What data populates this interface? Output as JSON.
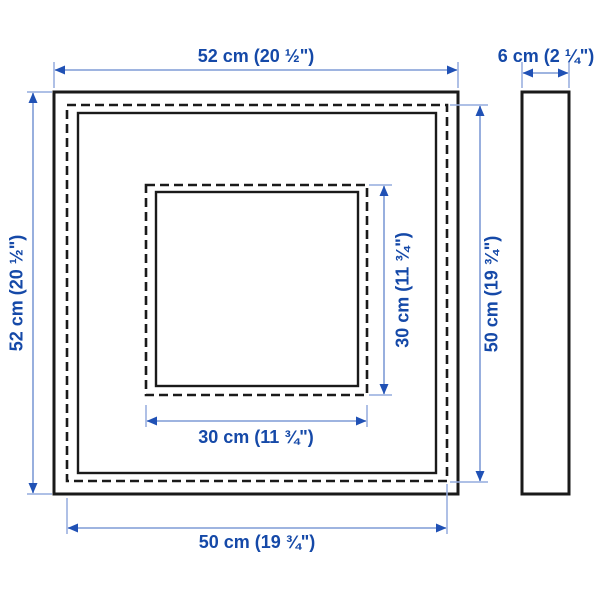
{
  "diagram": {
    "type": "product-measurement-illustration",
    "views": {
      "front": "frame-front-view",
      "side": "frame-side-profile-view"
    }
  },
  "dimensions": {
    "outer_width": "52 cm (20 ½\")",
    "outer_height": "52 cm (20 ½\")",
    "depth": "6 cm (2 ¼\")",
    "inner_width": "50 cm (19 ¾\")",
    "inner_height": "50 cm (19 ¾\")",
    "opening_width": "30 cm (11 ¾\")",
    "opening_height": "30 cm (11 ¾\")"
  },
  "colors": {
    "background": "#ffffff",
    "frame_outline": "#1a1a1a",
    "dimension_line": "#7e9bd6",
    "arrow": "#2051b5",
    "dimension_text": "#1549a8"
  }
}
